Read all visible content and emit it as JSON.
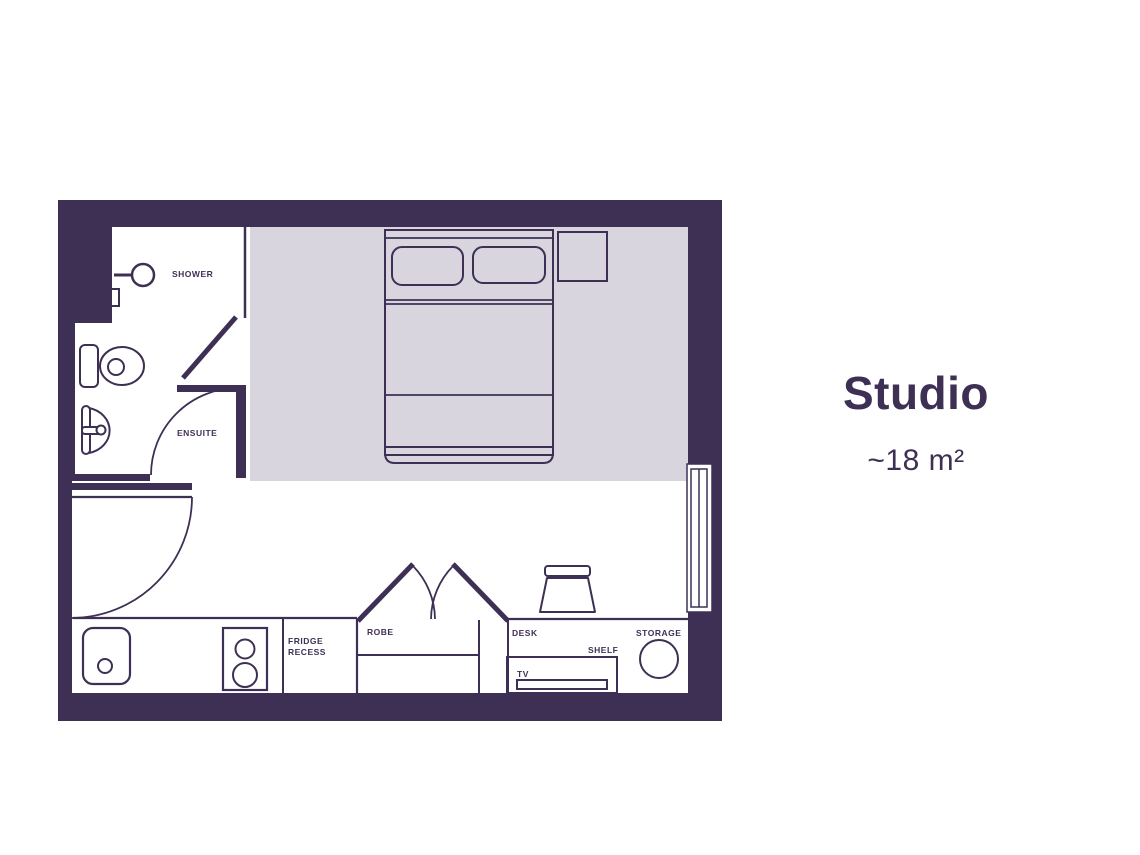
{
  "title_block": {
    "name": "Studio",
    "area": "~18 m²"
  },
  "floor_plan": {
    "colors": {
      "wall": "#3E3055",
      "floor": "#FFFFFF",
      "bed_zone": "#D8D5DE"
    },
    "labels": {
      "shower": "SHOWER",
      "ensuite": "ENSUITE",
      "fridge_line1": "FRIDGE",
      "fridge_line2": "RECESS",
      "robe": "ROBE",
      "desk": "DESK",
      "shelf": "SHELF",
      "tv": "TV",
      "storage": "STORAGE"
    }
  }
}
